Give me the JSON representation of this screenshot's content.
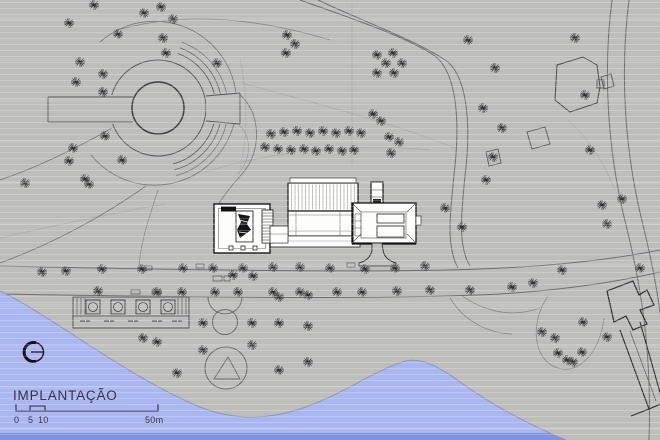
{
  "title": {
    "label": "IMPLANTAÇÃO"
  },
  "scale_bar": {
    "tick_0": "0",
    "tick_5": "5",
    "tick_10": "10",
    "end": "50m"
  },
  "north_arrow": {
    "name": "north-arrow-symbol"
  },
  "colors": {
    "land": "#bdbdba",
    "water": "#a9b6f1",
    "water_deep": "#8093e2",
    "road_line": "#6f6f6f",
    "building_line": "#1a1a1a",
    "building_fill": "#fdfdfc",
    "tree": "#3d3d3d",
    "text": "#35353d"
  },
  "plan": {
    "trees": [
      [
        69,
        23
      ],
      [
        94,
        5
      ],
      [
        144,
        13
      ],
      [
        161,
        7
      ],
      [
        173,
        19
      ],
      [
        118,
        34
      ],
      [
        163,
        38
      ],
      [
        166,
        53
      ],
      [
        80,
        62
      ],
      [
        103,
        74
      ],
      [
        76,
        82
      ],
      [
        103,
        92
      ],
      [
        217,
        63
      ],
      [
        105,
        136
      ],
      [
        122,
        160
      ],
      [
        73,
        148
      ],
      [
        69,
        161
      ],
      [
        85,
        179
      ],
      [
        25,
        183
      ],
      [
        89,
        184
      ],
      [
        287,
        35
      ],
      [
        295,
        44
      ],
      [
        286,
        53
      ],
      [
        377,
        55
      ],
      [
        393,
        53
      ],
      [
        386,
        63
      ],
      [
        402,
        63
      ],
      [
        377,
        73
      ],
      [
        394,
        73
      ],
      [
        373,
        114
      ],
      [
        381,
        121
      ],
      [
        389,
        137
      ],
      [
        399,
        142
      ],
      [
        391,
        153
      ],
      [
        271,
        134
      ],
      [
        284,
        132
      ],
      [
        297,
        131
      ],
      [
        310,
        133
      ],
      [
        323,
        131
      ],
      [
        336,
        133
      ],
      [
        349,
        131
      ],
      [
        361,
        133
      ],
      [
        265,
        147
      ],
      [
        278,
        149
      ],
      [
        291,
        150
      ],
      [
        304,
        149
      ],
      [
        316,
        151
      ],
      [
        329,
        149
      ],
      [
        342,
        151
      ],
      [
        354,
        150
      ],
      [
        42,
        272
      ],
      [
        66,
        271
      ],
      [
        102,
        269
      ],
      [
        142,
        269
      ],
      [
        183,
        268
      ],
      [
        213,
        268
      ],
      [
        243,
        268
      ],
      [
        273,
        267
      ],
      [
        300,
        267
      ],
      [
        330,
        268
      ],
      [
        365,
        269
      ],
      [
        395,
        268
      ],
      [
        425,
        266
      ],
      [
        98,
        291
      ],
      [
        157,
        292
      ],
      [
        182,
        292
      ],
      [
        215,
        292
      ],
      [
        238,
        292
      ],
      [
        273,
        292
      ],
      [
        300,
        292
      ],
      [
        337,
        292
      ],
      [
        362,
        292
      ],
      [
        397,
        291
      ],
      [
        430,
        290
      ],
      [
        470,
        290
      ],
      [
        512,
        287
      ],
      [
        533,
        283
      ],
      [
        562,
        270
      ],
      [
        468,
        40
      ],
      [
        495,
        68
      ],
      [
        483,
        108
      ],
      [
        502,
        128
      ],
      [
        493,
        157
      ],
      [
        486,
        180
      ],
      [
        462,
        227
      ],
      [
        445,
        208
      ],
      [
        575,
        38
      ],
      [
        585,
        95
      ],
      [
        590,
        150
      ],
      [
        602,
        205
      ],
      [
        607,
        224
      ],
      [
        622,
        199
      ],
      [
        640,
        268
      ],
      [
        542,
        332
      ],
      [
        555,
        338
      ],
      [
        558,
        353
      ],
      [
        582,
        352
      ],
      [
        567,
        360
      ],
      [
        573,
        362
      ],
      [
        583,
        322
      ],
      [
        607,
        337
      ],
      [
        203,
        323
      ],
      [
        252,
        323
      ],
      [
        203,
        350
      ],
      [
        252,
        345
      ],
      [
        177,
        373
      ],
      [
        279,
        370
      ],
      [
        308,
        362
      ],
      [
        279,
        323
      ],
      [
        308,
        326
      ],
      [
        279,
        297
      ],
      [
        308,
        295
      ],
      [
        233,
        275
      ],
      [
        253,
        276
      ],
      [
        143,
        338
      ],
      [
        157,
        342
      ]
    ],
    "kiosks": {
      "unit_cx": [
        93,
        118,
        143,
        168
      ],
      "unit_y": 300,
      "unit_size": 14,
      "circle_r": 4.5
    },
    "dash_marks_x": [
      80,
      104,
      128,
      152,
      172
    ]
  }
}
